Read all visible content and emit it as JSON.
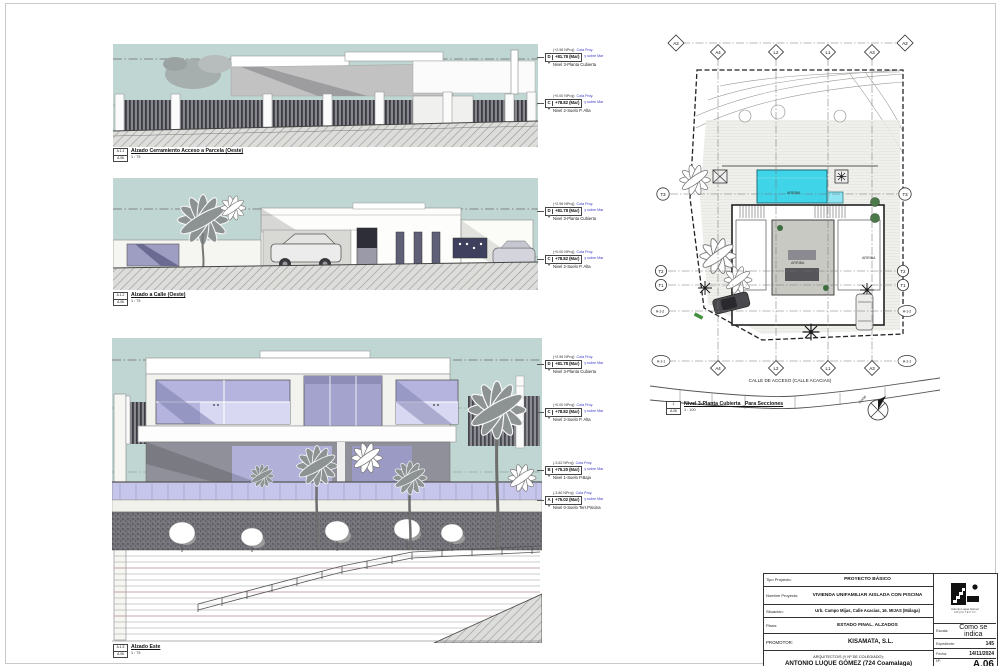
{
  "sheet": {
    "number": "A.06"
  },
  "colors": {
    "sky": "#c0d6d2",
    "glass": "#b4b4de",
    "glass_light": "#d8d8f2",
    "pool": "#3fd4e8",
    "annotation_blue": "#3939c4"
  },
  "views": [
    {
      "detail": "A.1.1",
      "sheet_ref": "A.06",
      "title": "Alzado Cerramiento Acceso a Parcela (Oeste)",
      "scale": "1 : 75"
    },
    {
      "detail": "A.1.2",
      "sheet_ref": "A.06",
      "title": "Alzado a Calle (Oeste)",
      "scale": "1 : 75"
    },
    {
      "detail": "A.1.3",
      "sheet_ref": "A.06",
      "title": "Alzado Este",
      "scale": "1 : 75"
    },
    {
      "detail": "1",
      "sheet_ref": "A.06",
      "title": "Nivel 3-Planta Cubierta _Para Secciones",
      "scale": "1 : 100"
    }
  ],
  "levels": {
    "cota": "Cota Proy.",
    "sobre": "y sobre Mar",
    "D": {
      "letter": "D",
      "proj": "(+2.96 NProj)",
      "value": "+81.78 (Mar)",
      "name": "Nivel 3-Planta Cubierta"
    },
    "C": {
      "letter": "C",
      "proj": "(+0.00 NProj)",
      "value": "+78.82 (Mar)",
      "name": "Nivel 2-Suelo P. Alta"
    },
    "B": {
      "letter": "B",
      "proj": "(-3.62 NProj)",
      "value": "+75.20 (Mar)",
      "name": "Nivel 1-Suelo P.Baja"
    },
    "A": {
      "letter": "A",
      "proj": "(-3.80 NProj)",
      "value": "+75.02 (Mar)",
      "name": "Nivel 0-Suelo Terr.Piscina"
    }
  },
  "plan": {
    "grid_top": [
      "A2",
      "A4",
      "L2",
      "L1",
      "A3",
      "A2"
    ],
    "grid_bottom": [
      "A4",
      "L2",
      "L1",
      "A3"
    ],
    "grid_side": [
      "T3",
      "T2",
      "T1"
    ],
    "sections": [
      "A-1-2",
      "A-1-1"
    ],
    "street": "CALLE DE ACCESO (CALLE ACACIAS)",
    "arriba": "ARRIBA",
    "north": "Norte"
  },
  "titleblock": {
    "tipo_label": "Tipo Proyecto:",
    "tipo": "PROYECTO BÁSICO",
    "nombre_label": "Nombre Proyecto:",
    "nombre": "VIVIENDA UNIFAMILIAR AISLADA CON PISCINA",
    "situacion_label": "Situación:",
    "situacion": "Urb. Campo Mijas, Calle Acacias, 16. MIJAS (Málaga)",
    "plano_label": "Plano:",
    "plano": "ESTADO FINAL. ALZADOS",
    "promotor_label": "PROMOTOR:",
    "promotor": "KISAMATA, S.L.",
    "arquitecto_label": "ARQUITECTO/S (Y Nº DE COLEGIADO):",
    "arquitecto": "ANTONIO LUQUE GÓMEZ (724 Coamalaga)",
    "escala_label": "Escala:",
    "escala": "Como se indica",
    "expediente_label": "Expediente:",
    "expediente": "145",
    "fecha_label": "Fecha:",
    "fecha": "14/11/2024",
    "numero_label": "Nº:",
    "numero": "A.06",
    "logo_name": "Antonio Luque Gómez",
    "logo_sub": "ARQUITECTO"
  }
}
